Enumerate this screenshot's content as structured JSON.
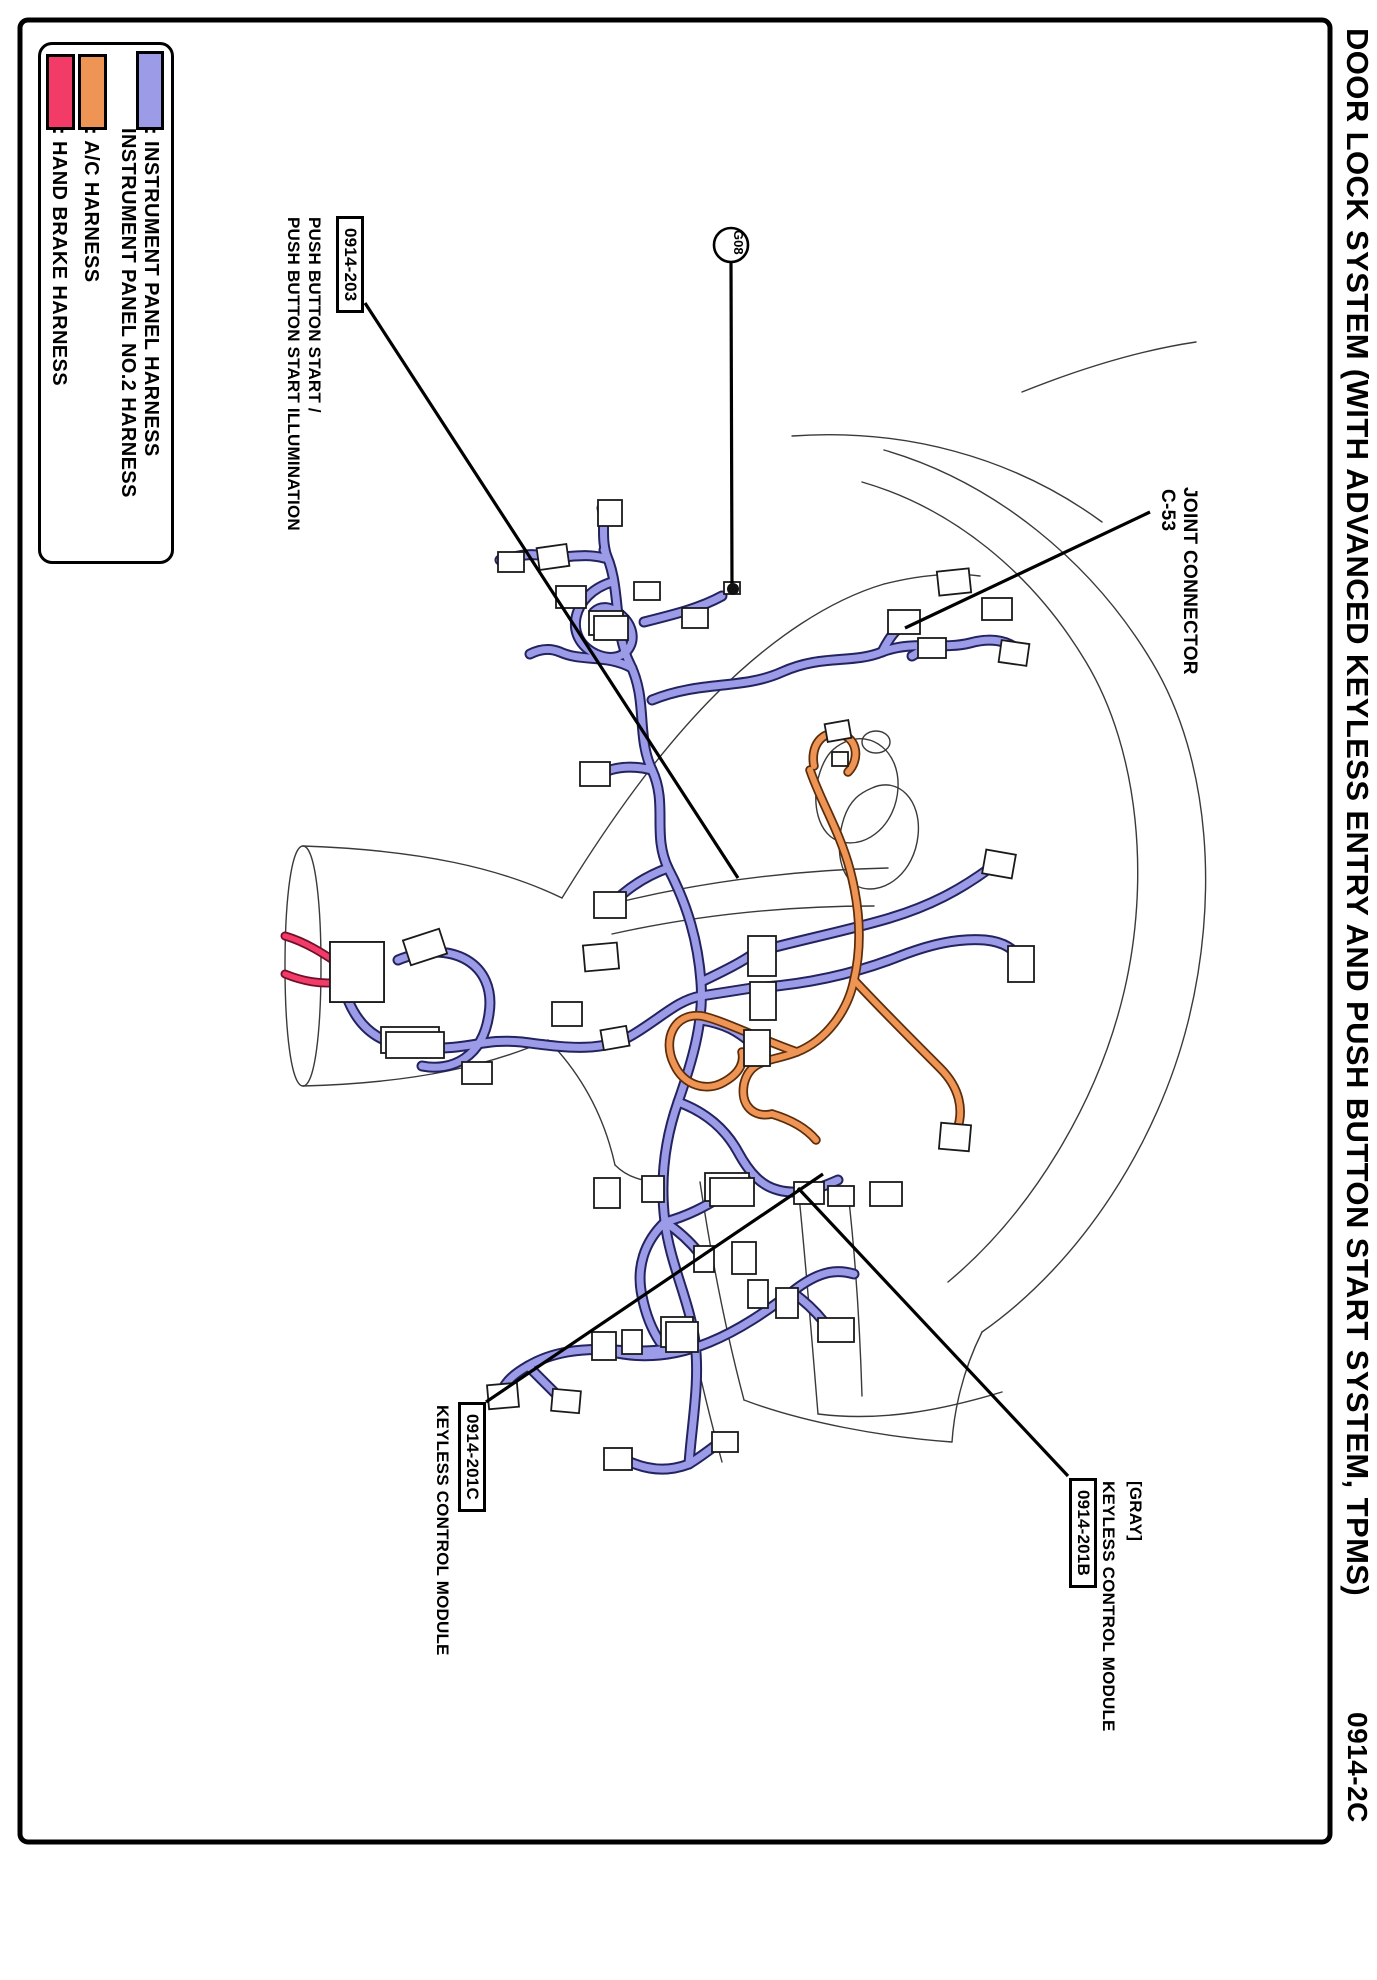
{
  "page": {
    "title": "DOOR LOCK SYSTEM (WITH ADVANCED KEYLESS ENTRY AND PUSH BUTTON START SYSTEM, TPMS)",
    "page_code": "0914-2C"
  },
  "legend": {
    "instrument_line1": ": INSTRUMENT PANEL HARNESS",
    "instrument_line2": "INSTRUMENT PANEL NO.2 HARNESS",
    "ac": ": A/C HARNESS",
    "hand_brake": ": HAND BRAKE HARNESS"
  },
  "callouts": {
    "push_button": {
      "code": "0914-203",
      "line1": "PUSH BUTTON START /",
      "line2": "PUSH BUTTON START ILLUMINATION"
    },
    "joint_connector": {
      "line1": "JOINT CONNECTOR",
      "line2": "C-53"
    },
    "ground": {
      "label": "G08"
    },
    "keyless_c": {
      "code": "0914-201C",
      "label": "KEYLESS CONTROL MODULE"
    },
    "keyless_b": {
      "color_note": "[GRAY]",
      "label": "KEYLESS CONTROL MODULE",
      "code": "0914-201B"
    }
  },
  "colors": {
    "blue": "#9b9be8",
    "blue_dark": "#23235f",
    "orange": "#ee9455",
    "orange_dark": "#5c2d0a",
    "pink": "#f23b66",
    "pink_dark": "#6e0f2c",
    "contour": "#3a3a3a",
    "leader": "#000000"
  }
}
